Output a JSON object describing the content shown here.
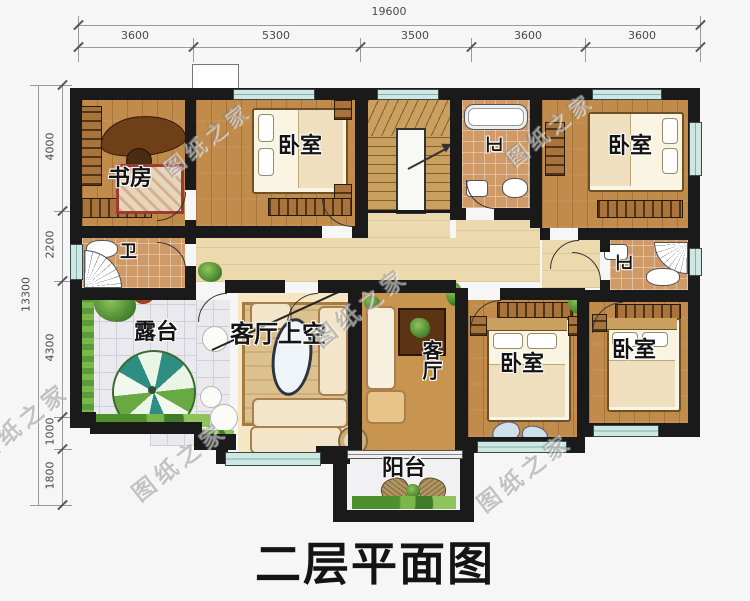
{
  "title": "二层平面图",
  "watermark_text": "图纸之家",
  "dimensions": {
    "top": {
      "total": "19600",
      "segments": [
        "3600",
        "5300",
        "3500",
        "3600",
        "3600"
      ]
    },
    "left": {
      "total": "13300",
      "segments": [
        "4000",
        "2200",
        "4300",
        "1000",
        "1800"
      ]
    }
  },
  "rooms": [
    {
      "id": "study",
      "label": "书房"
    },
    {
      "id": "bedroom-top-left",
      "label": "卧室"
    },
    {
      "id": "bath-top",
      "label": "卫"
    },
    {
      "id": "bedroom-top-right",
      "label": "卧室"
    },
    {
      "id": "bath-left",
      "label": "卫"
    },
    {
      "id": "bath-right",
      "label": "卫"
    },
    {
      "id": "terrace",
      "label": "露台"
    },
    {
      "id": "living-void",
      "label": "客厅上空"
    },
    {
      "id": "living",
      "label": "客厅"
    },
    {
      "id": "bedroom-bottom-middle",
      "label": "卧室"
    },
    {
      "id": "bedroom-bottom-right",
      "label": "卧室"
    },
    {
      "id": "balcony",
      "label": "阳台"
    }
  ],
  "colors": {
    "wall": "#1a1a1a",
    "wood": "#c08b4b",
    "wood_light": "#ecd9ad",
    "tile_warm": "#d09a68",
    "tile_gray": "#e9e9ee",
    "window": "#cfe7e3",
    "green": "#5a9b3c",
    "ink": "#141414"
  }
}
